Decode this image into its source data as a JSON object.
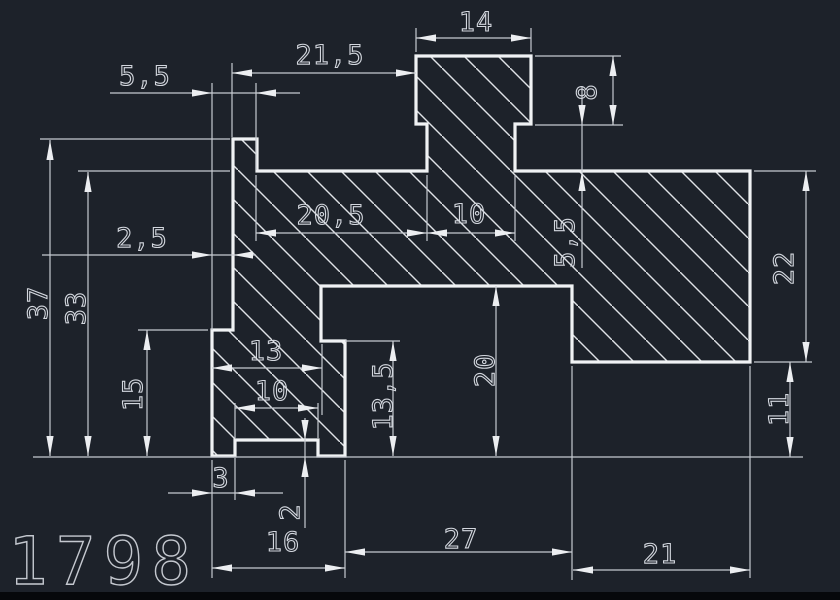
{
  "app": {
    "type": "cad-drawing-viewport",
    "colors": {
      "background": "#1d222a",
      "outline": "#f0f2f4",
      "hatch": "#dfe2e6",
      "dimension_lines": "#c6cad1",
      "dimension_text": "#d3d7de",
      "stamp_text": "#c4c8cf",
      "bottom_band": "#06080b"
    }
  },
  "drawing": {
    "stamp": "1798",
    "dimensions": {
      "tab_width": "14",
      "top_offset": "21,5",
      "left_lip_offset": "5,5",
      "tab_height": "8",
      "shelf_width": "20,5",
      "stem_width": "10",
      "stem_height": "5,5",
      "right_height": "22",
      "wall_offset": "2,5",
      "total_height": "37",
      "web_height": "33",
      "foot_step_left": "15",
      "tower_width": "13",
      "recess_width": "10",
      "foot_step_right": "13,5",
      "trench_depth": "20",
      "right_bottom": "11",
      "lip_left": "3",
      "recess_depth": "2",
      "foot_width": "16",
      "trench_width": "27",
      "right_block_width": "21"
    }
  }
}
